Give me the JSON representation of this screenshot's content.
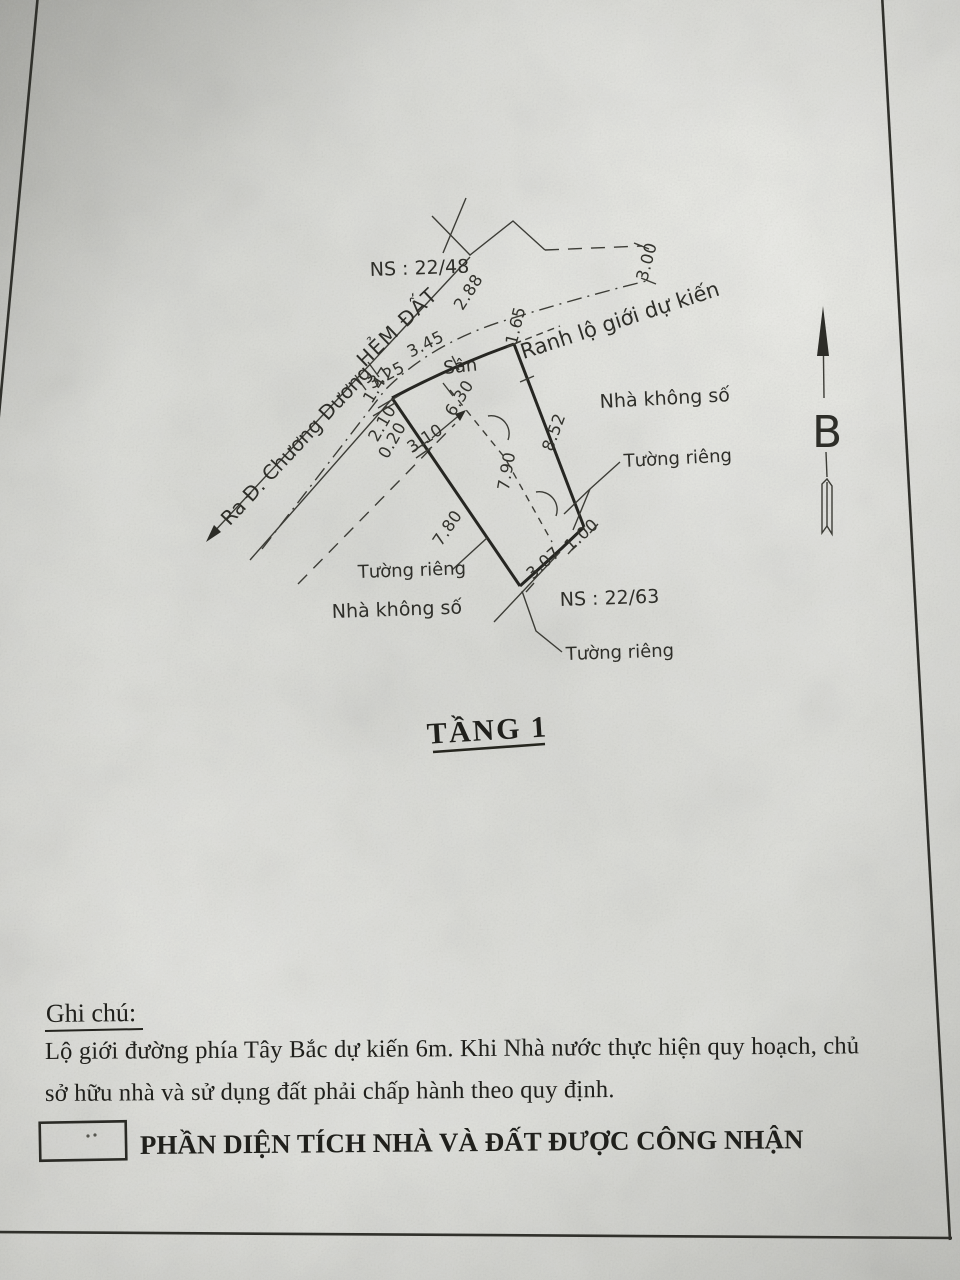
{
  "page": {
    "plan_title": "TẦNG 1",
    "north_label": "B",
    "parcels": {
      "top": "NS : 22/48",
      "bottom": "NS : 22/63"
    },
    "roads": {
      "alley": "HẺM ĐẤT",
      "direction": "Ra Đ. Chương Dương",
      "planned_boundary": "Ranh lộ giới dự kiến"
    },
    "areas": {
      "yard": "Sân",
      "house_right": "Nhà không số",
      "house_left": "Nhà không số"
    },
    "walls": {
      "right": "Tường riêng",
      "left": "Tường riêng",
      "bottom": "Tường riêng"
    },
    "dims": {
      "d288": "2.88",
      "d345": "3.45",
      "d325": "3.25",
      "d165": "1.65",
      "d300": "3.00",
      "d147": "1.47",
      "d210": "2.10",
      "d020": "0.20",
      "d310": "3.10",
      "d630": "6.30",
      "d852": "8.52",
      "d790": "7.90",
      "d780": "7.80",
      "d307": "3.07",
      "d100": "1.00"
    },
    "notes": {
      "heading": "Ghi chú:",
      "line1": "Lộ giới đường phía Tây Bắc dự kiến 6m. Khi Nhà nước thực hiện quy hoạch, chủ",
      "line2": "sở hữu nhà và sử dụng đất phải chấp hành theo quy định."
    },
    "legend": {
      "label": "PHẦN DIỆN TÍCH NHÀ VÀ ĐẤT ĐƯỢC CÔNG NHẬN"
    },
    "colors": {
      "ink": "#2c2c27",
      "paper": "#d6d7d2"
    }
  }
}
